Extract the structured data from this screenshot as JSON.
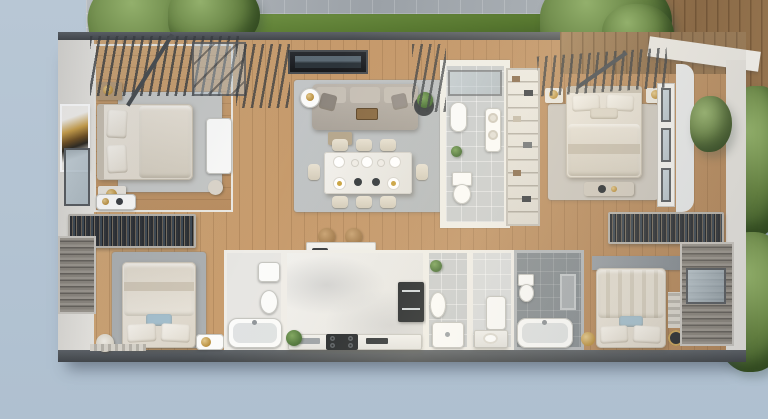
{
  "scene": {
    "kind": "3d-floorplan-top-view-render",
    "description": "Photorealistic top-down 3D render of an apartment floor plan with garden path, pergolas and timber deck",
    "palette": {
      "sky": "#b8c7d5",
      "sky2": "#afc0d0",
      "path_stone": "#a4aab0",
      "hedge_green": "#577730",
      "tree_green": "#637f41",
      "deck_wood": "#97754f",
      "wall_light": "#e7e5e0",
      "wall_dark": "#4d5155",
      "wood_floor": "#c29366",
      "marble": "#ebeae7",
      "tile_light": "#c9cccd",
      "tile_dark": "#868d92",
      "rug_grey": "#c6c8c7",
      "sofa_taupe": "#b7b0a7",
      "linen": "#ece7de",
      "accent_blue": "#a5c0ce",
      "appliance_black": "#1f2327",
      "gold": "#c9a35a",
      "plant_green": "#4c7437"
    },
    "environment": {
      "items": [
        "curved stone walkway",
        "curved boxwood hedge",
        "tree top-left",
        "tree top-center",
        "shrubs right",
        "tree bottom-right",
        "timber deck top-right",
        "stone slab on deck",
        "pergola louvres",
        "skylight"
      ]
    },
    "rooms": [
      {
        "id": "bedroom-1",
        "name": "Bedroom top-left",
        "floor": "wood",
        "furniture": [
          "double bed with side headboard",
          "wall artwork",
          "two nightstands with gold lamps",
          "white dresser",
          "stool",
          "grey rug",
          "pergola louvres above"
        ]
      },
      {
        "id": "living-dining",
        "name": "Living and dining room",
        "floor": "wood",
        "furniture": [
          "wall TV panel",
          "three-seat taupe sofa with cushions",
          "serving tray",
          "armchair",
          "white drum side table",
          "dark side table with plant",
          "grey rug",
          "marble dining table for eight",
          "place settings"
        ]
      },
      {
        "id": "bathroom-1",
        "name": "Guest bathroom",
        "floor": "tile-light",
        "furniture": [
          "wall-hung basin",
          "toilet",
          "towel shelf",
          "plant",
          "glass shower screen"
        ]
      },
      {
        "id": "master-bedroom",
        "name": "Master bedroom top-right",
        "floor": "wood",
        "furniture": [
          "double bed with top headboard",
          "two nightstands",
          "foot bench with tray",
          "grey rug",
          "window wall right",
          "pergola louvres above"
        ]
      },
      {
        "id": "hallway",
        "name": "Hallway with wardrobes",
        "floor": "wood",
        "furniture": [
          "open wardrobe left with hanging clothes",
          "vanity table",
          "open wardrobe right with hanging clothes",
          "kitchen island with breakfast items",
          "two rattan stools"
        ]
      },
      {
        "id": "kitchen",
        "name": "Kitchen",
        "floor": "marble",
        "furniture": [
          "island counter",
          "base counter with sink strip",
          "black gas cooktop",
          "built-in oven column",
          "potted plant"
        ]
      },
      {
        "id": "bedroom-2",
        "name": "Bedroom bottom-left",
        "floor": "wood",
        "furniture": [
          "double bed with blue cushion",
          "grey rug",
          "flower pouf",
          "white side cabinet",
          "striped runner",
          "louvred window wall left"
        ]
      },
      {
        "id": "bathroom-2",
        "name": "Bathroom with tub bottom-left",
        "floor": "marble",
        "furniture": [
          "bathtub",
          "vanity basin",
          "toilet"
        ]
      },
      {
        "id": "shower-room",
        "name": "Shower room",
        "floor": "tile-light",
        "furniture": [
          "shower tray",
          "pedestal basin",
          "plant shelf"
        ]
      },
      {
        "id": "wc",
        "name": "WC / vanity room",
        "floor": "tile-light",
        "furniture": [
          "vanity counter with basin",
          "tall white cabinet"
        ]
      },
      {
        "id": "bathroom-3",
        "name": "Dark-tiled bathroom",
        "floor": "tile-dark",
        "furniture": [
          "bathtub",
          "toilet",
          "towel niche"
        ]
      },
      {
        "id": "bedroom-3",
        "name": "Bedroom bottom-right",
        "floor": "wood",
        "furniture": [
          "double bed with blue cushion",
          "stone headboard panel",
          "gold side stools",
          "striped rug",
          "louvred shutter wall with window"
        ]
      }
    ]
  }
}
